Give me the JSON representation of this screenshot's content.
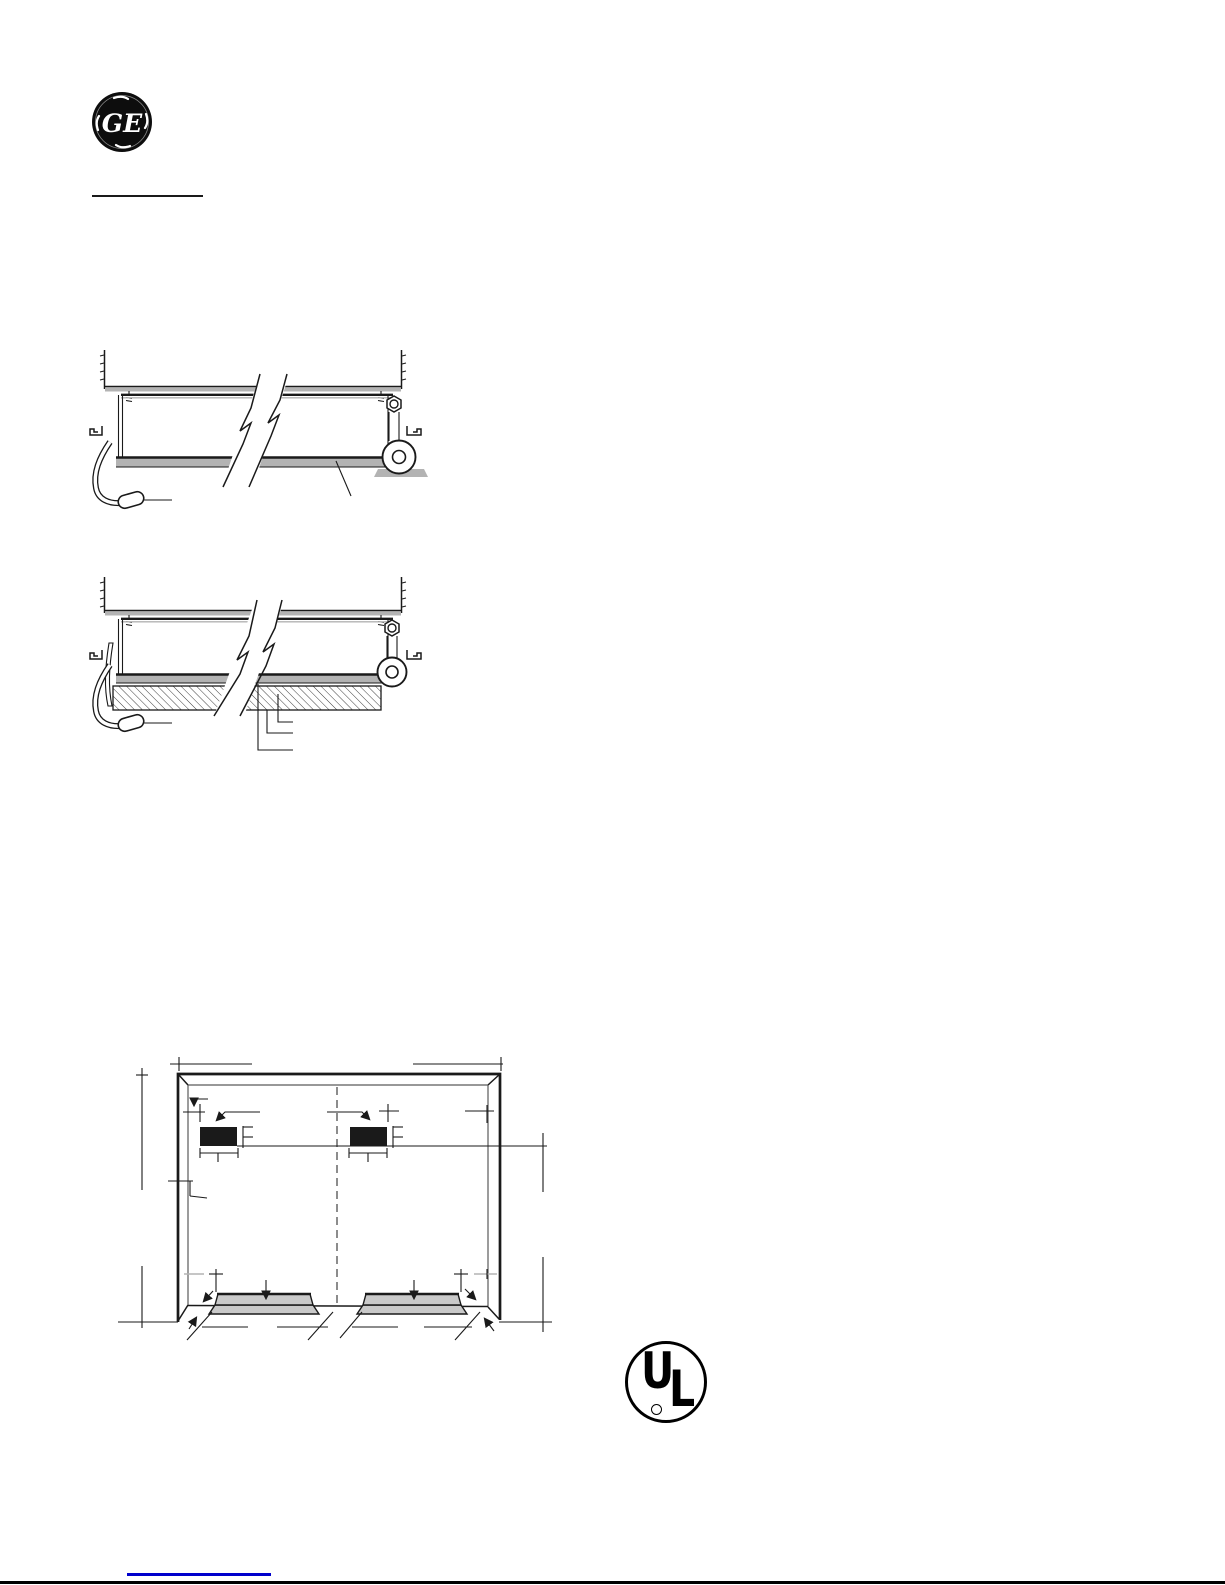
{
  "page": {
    "width": 1225,
    "height": 1585,
    "background": "#ffffff"
  },
  "branding": {
    "ge_monogram": "GE"
  },
  "certification": {
    "ul_u": "U",
    "ul_l": "L"
  },
  "colors": {
    "line": "#1a1a1a",
    "inner_line": "#5a5a5a",
    "gray_band": "#b3b3b3",
    "ramp_fill": "#c9c9c9",
    "centerline": "#8c8c8c",
    "hatch_line": "#2a2a2a",
    "link_underline": "#0000cc",
    "logo_black": "#0d0d0d",
    "bottom_rule": "#000000"
  }
}
